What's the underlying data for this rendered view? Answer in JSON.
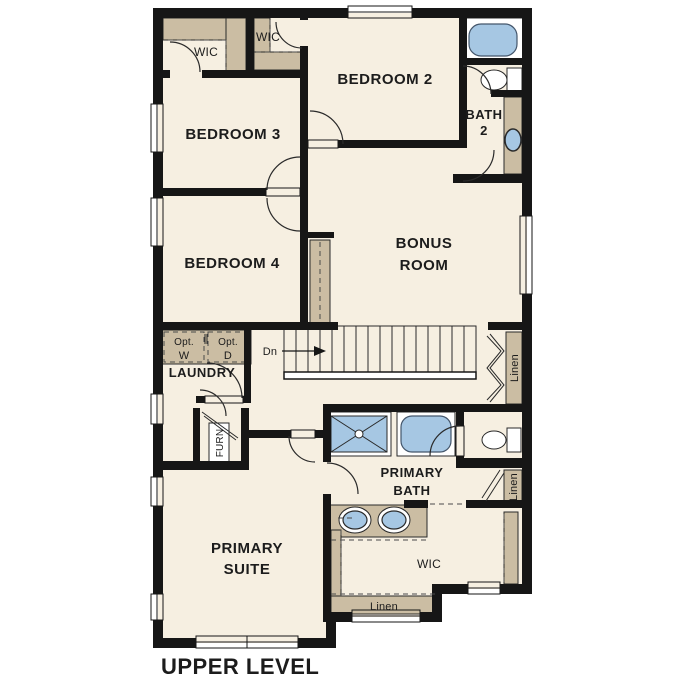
{
  "title": "UPPER LEVEL",
  "rooms": {
    "bedroom2": "BEDROOM 2",
    "bedroom3": "BEDROOM 3",
    "bedroom4": "BEDROOM 4",
    "bonus_line1": "BONUS",
    "bonus_line2": "ROOM",
    "bath2_line1": "BATH",
    "bath2_line2": "2",
    "primary_bath_line1": "PRIMARY",
    "primary_bath_line2": "BATH",
    "primary_suite_line1": "PRIMARY",
    "primary_suite_line2": "SUITE",
    "laundry": "LAUNDRY"
  },
  "closets": {
    "wic_bedroom3": "WIC",
    "wic_bedroom2": "WIC",
    "wic_primary": "WIC",
    "linen_upper": "Linen",
    "linen_lower": "Linen",
    "linen_wic": "Linen"
  },
  "annotations": {
    "stairs_down": "Dn",
    "furnace": "FURN",
    "opt_washer_line1": "Opt.",
    "opt_washer_line2": "W",
    "opt_dryer_line1": "Opt.",
    "opt_dryer_line2": "D"
  },
  "colors": {
    "wall": "#161616",
    "floor": "#f6efe1",
    "shelf": "#cbbda3",
    "fixture": "#a6c7e3",
    "appliance": "#e6e6e6"
  }
}
